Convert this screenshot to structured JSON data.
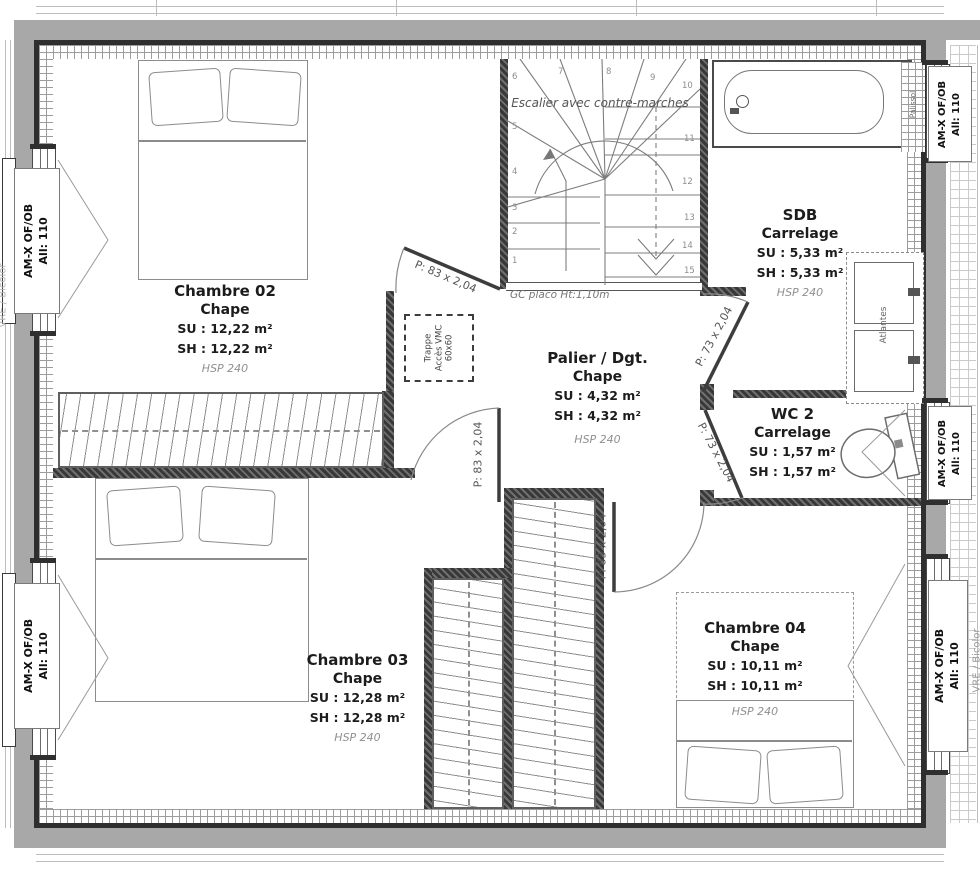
{
  "plan": {
    "rooms": [
      {
        "name": "Chambre 02",
        "finish": "Chape",
        "su": "SU : 12,22 m²",
        "sh": "SH : 12,22 m²",
        "hsp": "HSP 240"
      },
      {
        "name": "Chambre 03",
        "finish": "Chape",
        "su": "SU : 12,28 m²",
        "sh": "SH : 12,28 m²",
        "hsp": "HSP 240"
      },
      {
        "name": "Chambre 04",
        "finish": "Chape",
        "su": "SU : 10,11 m²",
        "sh": "SH : 10,11 m²",
        "hsp": "HSP 240"
      },
      {
        "name": "SDB",
        "finish": "Carrelage",
        "su": "SU : 5,33 m²",
        "sh": "SH : 5,33 m²",
        "hsp": "HSP 240"
      },
      {
        "name": "WC 2",
        "finish": "Carrelage",
        "su": "SU : 1,57 m²",
        "sh": "SH : 1,57 m²",
        "hsp": ""
      },
      {
        "name": "Palier / Dgt.",
        "finish": "Chape",
        "su": "SU : 4,32 m²",
        "sh": "SH : 4,32 m²",
        "hsp": "HSP 240"
      }
    ],
    "doors": [
      {
        "label": "P: 83 x 2,04"
      },
      {
        "label": "P: 73 x 2,04"
      },
      {
        "label": "P: 73 x 2,04"
      },
      {
        "label": "P: 83 x 2,04"
      },
      {
        "label": "P: 83 x 2,04"
      }
    ],
    "window_label": {
      "line1": "AM-X OF/OB",
      "line2": "All: 110"
    },
    "stairs": {
      "title": "Escalier avec contre-marches",
      "note": "GC placo Ht:1,10m",
      "numbers": [
        "1",
        "2",
        "3",
        "4",
        "5",
        "6",
        "7",
        "8",
        "9",
        "10",
        "11",
        "12",
        "13",
        "14",
        "15"
      ]
    },
    "annotations": {
      "trappe_line1": "Trappe",
      "trappe_line2": "Accès VMC",
      "trappe_line3": "60x60",
      "atlantes": "Atlantes",
      "palissol": "Palissol",
      "vre_bicolor": "VRE / Bicolor"
    }
  }
}
